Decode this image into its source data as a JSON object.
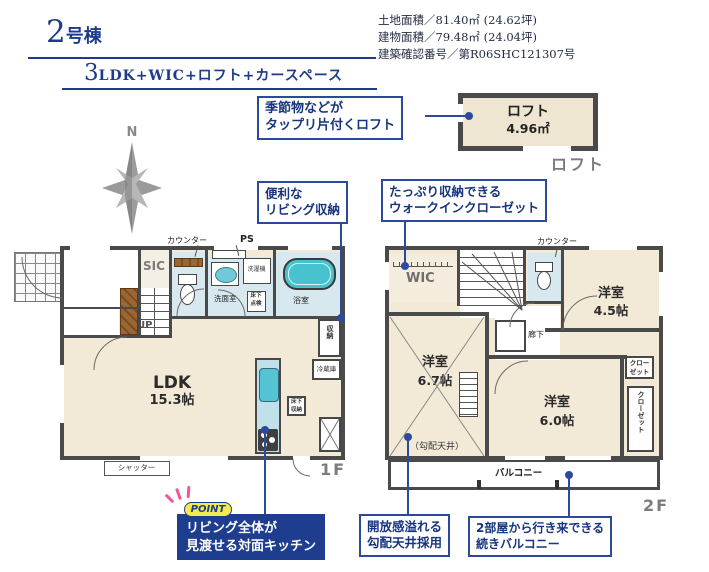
{
  "colors": {
    "accent_navy": "#1d3a8d",
    "callout_blue": "#2b4a9e",
    "wall_gray": "#4a4a4a",
    "room_beige": "#f2e9d6",
    "wet_blue": "#d7e9ef",
    "tub_teal": "#49c2cf",
    "wood_brown": "#8a5a2e",
    "caption_gray": "#7c7c7c",
    "point_bg_navy": "#1e3d8f",
    "point_badge_yellow": "#f3ea4e",
    "point_ray_pink": "#f0569c"
  },
  "header": {
    "title_num": "2",
    "title_suffix": "号棟",
    "plan_num": "3",
    "plan_suffix": "LDK+WIC+ロフト+カースペース",
    "info": [
      "土地面積／81.40㎡ (24.62坪)",
      "建物面積／79.48㎡ (24.04坪)",
      "建築確認番号／第R06SHC121307号"
    ]
  },
  "compass": {
    "north": "N"
  },
  "loft": {
    "name": "ロフト",
    "area": "4.96㎡",
    "caption": "ロフト"
  },
  "callouts": {
    "loft": {
      "line1": "季節物などが",
      "line2": "タップリ片付くロフト"
    },
    "living": {
      "line1": "便利な",
      "line2": "リビング収納"
    },
    "wic": {
      "line1": "たっぷり収納できる",
      "line2": "ウォークインクローゼット"
    },
    "ceiling": {
      "line1": "開放感溢れる",
      "line2": "勾配天井採用"
    },
    "balcony": {
      "line1": "2部屋から行き来できる",
      "line2": "続きバルコニー"
    },
    "point": {
      "badge": "POINT",
      "line1": "リビング全体が",
      "line2": "見渡せる対面キッチン"
    }
  },
  "f1": {
    "caption": "1F",
    "genkan": "玄関",
    "hall": "廊下",
    "sic": "SIC",
    "up": "UP",
    "counter": "カウンター",
    "ps": "PS",
    "washroom": "洗面室",
    "hatch1": "床下",
    "hatch2": "点検",
    "laundry": "洗濯機",
    "bath": "浴室",
    "ldk": "LDK",
    "ldk_area": "15.3帖",
    "fridge": "冷蔵庫",
    "uf1": "床下",
    "uf2": "収納",
    "storage": "収納",
    "shutter": "シャッター"
  },
  "f2": {
    "caption": "2F",
    "wic": "WIC",
    "dn": "DN",
    "counter": "カウンター",
    "hall": "廊下",
    "room45": "洋室",
    "room45_area": "4.5帖",
    "room67": "洋室",
    "room67_area": "6.7帖",
    "room60": "洋室",
    "room60_area": "6.0帖",
    "sloped": "（勾配天井）",
    "closet_a1": "クロー",
    "closet_a2": "ゼット",
    "closet_b": "クローゼット",
    "balcony": "バルコニー"
  }
}
